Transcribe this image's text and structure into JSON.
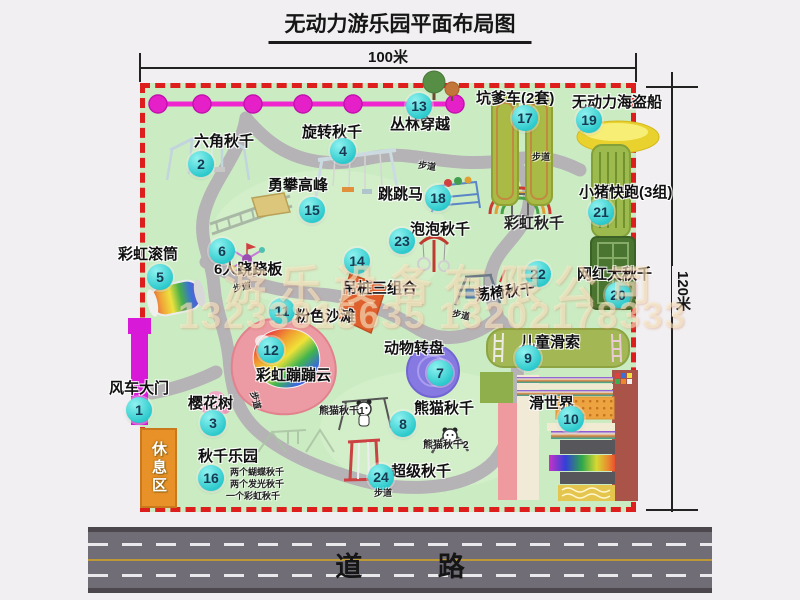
{
  "title": "无动力游乐园平面布局图",
  "dimensions": {
    "top": "100米",
    "right": "120米"
  },
  "road": {
    "label": "道 路"
  },
  "watermark": {
    "line1": "游乐设备有限公司",
    "line2": "13233815635 13202178333"
  },
  "rest_area": {
    "label": "休息区"
  },
  "attractions": [
    {
      "n": 1,
      "label": "风车大门",
      "lx": 109,
      "ly": 381,
      "bx": 139,
      "by": 410
    },
    {
      "n": 2,
      "label": "六角秋千",
      "lx": 194,
      "ly": 134,
      "bx": 201,
      "by": 164
    },
    {
      "n": 3,
      "label": "樱花树",
      "lx": 188,
      "ly": 396,
      "bx": 213,
      "by": 423
    },
    {
      "n": 4,
      "label": "旋转秋千",
      "lx": 302,
      "ly": 125,
      "bx": 343,
      "by": 151
    },
    {
      "n": 5,
      "label": "彩虹滚筒",
      "lx": 118,
      "ly": 247,
      "bx": 160,
      "by": 277
    },
    {
      "n": 6,
      "label": "6人跷跷板",
      "lx": 214,
      "ly": 262,
      "bx": 222,
      "by": 251
    },
    {
      "n": 7,
      "label": "动物转盘",
      "lx": 384,
      "ly": 341,
      "bx": 440,
      "by": 373
    },
    {
      "n": 8,
      "label": "熊猫秋千",
      "lx": 414,
      "ly": 401,
      "bx": 403,
      "by": 424
    },
    {
      "n": 9,
      "label": "儿童滑索",
      "lx": 520,
      "ly": 335,
      "bx": 528,
      "by": 358
    },
    {
      "n": 10,
      "label": "滑世界",
      "lx": 529,
      "ly": 396,
      "bx": 571,
      "by": 419
    },
    {
      "n": 11,
      "label": "粉色沙滩",
      "lx": 295,
      "ly": 309,
      "bx": 282,
      "by": 311
    },
    {
      "n": 12,
      "label": "彩虹蹦蹦云",
      "lx": 256,
      "ly": 368,
      "bx": 271,
      "by": 350
    },
    {
      "n": 13,
      "label": "丛林穿越",
      "lx": 390,
      "ly": 117,
      "bx": 419,
      "by": 106
    },
    {
      "n": 14,
      "label": "吊桩三组合",
      "lx": 342,
      "ly": 281,
      "bx": 357,
      "by": 261
    },
    {
      "n": 15,
      "label": "勇攀高峰",
      "lx": 268,
      "ly": 178,
      "bx": 312,
      "by": 210
    },
    {
      "n": 16,
      "label": "秋千乐园",
      "lx": 198,
      "ly": 449,
      "bx": 211,
      "by": 478
    },
    {
      "n": 17,
      "label": "坑爹车(2套)",
      "lx": 476,
      "ly": 91,
      "bx": 525,
      "by": 118
    },
    {
      "n": 18,
      "label": "跳跳马",
      "lx": 378,
      "ly": 187,
      "bx": 438,
      "by": 198
    },
    {
      "n": 19,
      "label": "无动力海盗船",
      "lx": 572,
      "ly": 95,
      "bx": 589,
      "by": 120
    },
    {
      "n": 20,
      "label": "网红大秋千",
      "lx": 577,
      "ly": 267,
      "bx": 618,
      "by": 295
    },
    {
      "n": 21,
      "label": "小猪快跑(3组)",
      "lx": 579,
      "ly": 185,
      "bx": 601,
      "by": 212
    },
    {
      "n": 22,
      "label": "荡椅秋千",
      "lx": 475,
      "ly": 285,
      "bx": 538,
      "by": 274,
      "rot": -7
    },
    {
      "n": 23,
      "label": "泡泡秋千",
      "lx": 410,
      "ly": 222,
      "bx": 402,
      "by": 241
    },
    {
      "n": 24,
      "label": "超级秋千",
      "lx": 391,
      "ly": 464,
      "bx": 381,
      "by": 477
    }
  ],
  "notes": [
    {
      "text": "彩虹秋千",
      "x": 504,
      "y": 216,
      "size": 15
    },
    {
      "text": "熊猫秋千1",
      "x": 319,
      "y": 407,
      "size": 10
    },
    {
      "text": "熊猫秋千2",
      "x": 423,
      "y": 441,
      "size": 10
    },
    {
      "text": "两个蝴蝶秋千",
      "x": 230,
      "y": 468,
      "size": 9
    },
    {
      "text": "两个发光秋千",
      "x": 230,
      "y": 480,
      "size": 9
    },
    {
      "text": "一个彩虹秋千",
      "x": 226,
      "y": 492,
      "size": 9
    },
    {
      "text": "步道",
      "x": 233,
      "y": 283,
      "size": 9,
      "rot": -12
    },
    {
      "text": "步道",
      "x": 418,
      "y": 162,
      "size": 9,
      "rot": 8
    },
    {
      "text": "步道",
      "x": 532,
      "y": 153,
      "size": 9
    },
    {
      "text": "步道",
      "x": 452,
      "y": 311,
      "size": 9,
      "rot": 12
    },
    {
      "text": "步道",
      "x": 246,
      "y": 396,
      "size": 9,
      "rot": 75
    },
    {
      "text": "步道",
      "x": 374,
      "y": 489,
      "size": 9
    }
  ]
}
